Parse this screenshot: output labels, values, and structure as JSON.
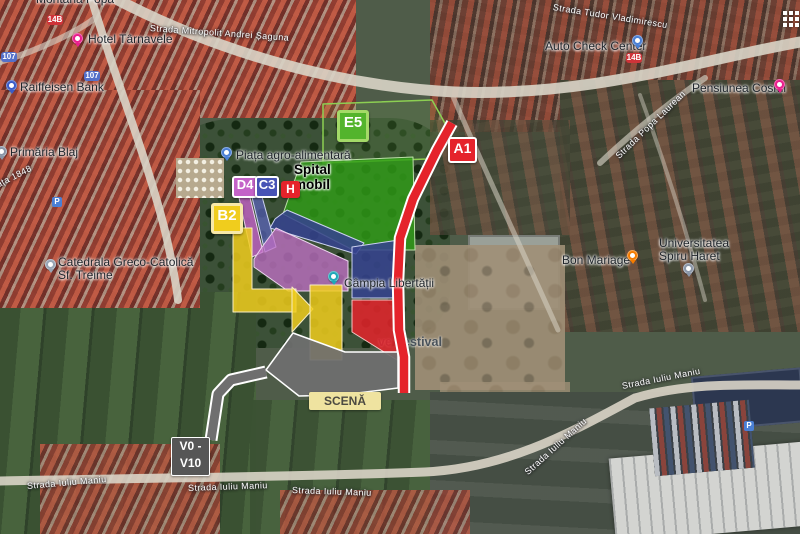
{
  "map": {
    "canvas": {
      "width": 800,
      "height": 534
    },
    "zones": [
      {
        "name": "zone-e5-area",
        "points": "323,104 432,100 447,127 427,159 323,163",
        "fill": "#7dc44a",
        "fill_opacity": 0.13,
        "stroke": "#8ccf52",
        "stroke_width": 1.5
      },
      {
        "name": "zone-green-field",
        "points": "301,162 413,157 415,250 353,250 283,214",
        "fill": "#2f9e17",
        "fill_opacity": 0.8,
        "stroke": "#bcdfa9",
        "stroke_width": 1
      },
      {
        "name": "zone-navy-band",
        "points": "275,219 287,210 364,243 356,254 270,228",
        "fill": "#36438f",
        "fill_opacity": 0.87,
        "stroke": "#ccd2f0",
        "stroke_width": 1
      },
      {
        "name": "zone-navy-block",
        "points": "352,247 399,240 399,298 352,298",
        "fill": "#36438f",
        "fill_opacity": 0.87,
        "stroke": "#ccd2f0",
        "stroke_width": 1
      },
      {
        "name": "zone-d4-path",
        "points": "238,193 249,193 263,252 252,257",
        "fill": "#c463c8",
        "fill_opacity": 0.8,
        "stroke": "#ecd4ee",
        "stroke_width": 1
      },
      {
        "name": "zone-c3-path",
        "points": "251,193 261,193 276,247 265,252",
        "fill": "#5a63b8",
        "fill_opacity": 0.75,
        "stroke": "#ccd2f0",
        "stroke_width": 1
      },
      {
        "name": "zone-purple",
        "points": "276,228 348,261 348,291 288,291 254,267 254,259 262,247",
        "fill": "#c06fc5",
        "fill_opacity": 0.78,
        "stroke": "#ecd4ee",
        "stroke_width": 1
      },
      {
        "name": "zone-yellow-path",
        "points": "233,228 252,228 252,289 296,289 296,312 233,312",
        "fill": "#f0cd1d",
        "fill_opacity": 0.85,
        "stroke": "#f8ecc2",
        "stroke_width": 1
      },
      {
        "name": "zone-yellow-arrow",
        "points": "292,287 313,309 292,332",
        "fill": "#f0cd1d",
        "fill_opacity": 0.85,
        "stroke": "#f8ecc2",
        "stroke_width": 1
      },
      {
        "name": "zone-yellow-block",
        "points": "310,285 342,285 342,360 310,360",
        "fill": "#f0cd1d",
        "fill_opacity": 0.85,
        "stroke": "#f8ecc2",
        "stroke_width": 1
      },
      {
        "name": "zone-red-block",
        "points": "352,300 397,300 397,360 352,332",
        "fill": "#e5232b",
        "fill_opacity": 0.85,
        "stroke": "#f5c5c5",
        "stroke_width": 1
      },
      {
        "name": "zone-stage-gray",
        "points": "293,333 345,352 398,352 398,388 341,395 299,396 266,370",
        "fill": "#6f6f6f",
        "fill_opacity": 0.93,
        "stroke": "#ffffff",
        "stroke_width": 1.5
      }
    ],
    "paths": [
      {
        "name": "stage-access-path",
        "points": "266,372 231,380 218,394 211,440",
        "color": "#6f6f6f",
        "width": 9,
        "casing_color": "#ffffff",
        "casing_width": 13
      },
      {
        "name": "route-a1",
        "points": "452,123 437,150 413,199 400,238 398,281 399,330 404,357 404,393",
        "color": "#e5232b",
        "width": 8.5,
        "casing_color": "#ffffff",
        "casing_width": 12.5
      }
    ],
    "overlay_badges": [
      {
        "name": "badge-e5",
        "label": "E5",
        "x": 337,
        "y": 110,
        "w": 26,
        "h": 26,
        "bg": "#53b42c",
        "border": "#a4da68",
        "border_w": 3,
        "font_size": 15
      },
      {
        "name": "badge-a1",
        "label": "A1",
        "x": 448,
        "y": 137,
        "w": 25,
        "h": 22,
        "bg": "#e5232b",
        "border": "#ffffff",
        "border_w": 2,
        "font_size": 14
      },
      {
        "name": "badge-d4",
        "label": "D4",
        "x": 232,
        "y": 176,
        "w": 22,
        "h": 18,
        "bg": "#c463c8",
        "border": "#ffffff",
        "border_w": 2,
        "font_size": 13
      },
      {
        "name": "badge-c3",
        "label": "C3",
        "x": 255,
        "y": 176,
        "w": 20,
        "h": 18,
        "bg": "#4753b5",
        "border": "#ffffff",
        "border_w": 2,
        "font_size": 13
      },
      {
        "name": "badge-h",
        "label": "H",
        "x": 281,
        "y": 181,
        "w": 19,
        "h": 17,
        "bg": "#e5232b",
        "border": "#e5232b",
        "border_w": 0,
        "font_size": 12
      },
      {
        "name": "badge-b2",
        "label": "B2",
        "x": 211,
        "y": 203,
        "w": 26,
        "h": 25,
        "bg": "#f0cd1d",
        "border": "#f7e9a8",
        "border_w": 3,
        "font_size": 15
      }
    ],
    "overlay_boxes": [
      {
        "name": "box-v0-v10",
        "lines": [
          "V0 -",
          "V10"
        ],
        "x": 171,
        "y": 437,
        "w": 37,
        "h": 37,
        "bg": "#565656",
        "color": "#ffffff",
        "border": "#ffffff",
        "font_size": 12
      },
      {
        "name": "box-scena",
        "lines": [
          "SCENĂ"
        ],
        "x": 309,
        "y": 392,
        "w": 70,
        "h": 16,
        "bg": "#efe3a0",
        "color": "#4c4a42",
        "border": "#efe3a0",
        "font_size": 12
      }
    ],
    "poi_labels": [
      {
        "name": "montana-popa",
        "text": "Montana Popa",
        "x": 36,
        "y": -7
      },
      {
        "name": "hotel-tarnavele",
        "text": "Hotel Târnavele",
        "x": 88,
        "y": 33,
        "icon": "hotel-pin",
        "icon_color": "#e91e8c",
        "icon_x": 72,
        "icon_y": 33
      },
      {
        "name": "raiffeisen-bank",
        "text": "Raiffeisen Bank",
        "x": 20,
        "y": 81,
        "icon": "bank-pin",
        "icon_color": "#3a5bc7",
        "icon_x": 6,
        "icon_y": 80
      },
      {
        "name": "primaria-blaj",
        "text": "Primăria Blaj",
        "x": 10,
        "y": 146,
        "icon": "government-pin",
        "icon_color": "#8a96a8",
        "icon_x": -4,
        "icon_y": 146
      },
      {
        "name": "catedrala-greco-catolica",
        "text": "Catedrala Greco-Catolică\nSf. Treime",
        "x": 58,
        "y": 256,
        "icon": "church-pin",
        "icon_color": "#97a5b5",
        "icon_x": 45,
        "icon_y": 259
      },
      {
        "name": "piata-agro-alimentara",
        "text": "Piața agro-alimentară",
        "x": 236,
        "y": 149,
        "icon": "market-pin",
        "icon_color": "#4a7fd4",
        "icon_x": 221,
        "icon_y": 147
      },
      {
        "name": "campia-libertatii",
        "text": "Câmpia Libertății",
        "x": 344,
        "y": 277,
        "icon": "park-pin",
        "icon_color": "#1fa8b8",
        "icon_x": 328,
        "icon_y": 271
      },
      {
        "name": "bon-mariage",
        "text": "Bon Mariage",
        "x": 562,
        "y": 254,
        "icon": "restaurant-pin",
        "icon_color": "#f57c00",
        "icon_x": 627,
        "icon_y": 250
      },
      {
        "name": "universitatea-spiru-haret",
        "text": "Universitatea\nSpiru Haret",
        "x": 659,
        "y": 237,
        "icon": "university-pin",
        "icon_color": "#8a96a8",
        "icon_x": 683,
        "icon_y": 263
      },
      {
        "name": "auto-check-center",
        "text": "Auto Check Center",
        "x": 545,
        "y": 40,
        "icon": "auto-pin",
        "icon_color": "#4a7fd4",
        "icon_x": 632,
        "icon_y": 35
      },
      {
        "name": "pensiunea-cosmi",
        "text": "Pensiunea Cosmi",
        "x": 692,
        "y": 82,
        "icon": "lodging-pin",
        "icon_color": "#e91e8c",
        "icon_x": 774,
        "icon_y": 79
      },
      {
        "name": "spital-mobil",
        "text": "Spital\nmobil",
        "x": 294,
        "y": 163,
        "variant": "overlay-black"
      },
      {
        "name": "festival",
        "text": "ve Festival",
        "x": 378,
        "y": 336,
        "variant": "festival"
      }
    ],
    "street_labels": [
      {
        "name": "strada-mitropolit-andrei-saguna",
        "text": "Strada Mitropolit Andrei Șaguna",
        "x": 150,
        "y": 23,
        "rotate": 4
      },
      {
        "name": "strada-tudor-vladimirescu",
        "text": "Strada Tudor Vladimirescu",
        "x": 553,
        "y": 2,
        "rotate": 9
      },
      {
        "name": "piata-1848",
        "text": "ața 1848",
        "x": -3,
        "y": 180,
        "rotate": -27
      },
      {
        "name": "strada-popa-laurean",
        "text": "Strada Popa Laurean",
        "x": 617,
        "y": 152,
        "rotate": -44
      },
      {
        "name": "strada-iuliu-maniu-1",
        "text": "Strada Iuliu Maniu",
        "x": 27,
        "y": 481,
        "rotate": -5
      },
      {
        "name": "strada-iuliu-maniu-2",
        "text": "Strada Iuliu Maniu",
        "x": 188,
        "y": 483,
        "rotate": -2
      },
      {
        "name": "strada-iuliu-maniu-3",
        "text": "Strada Iuliu Maniu",
        "x": 292,
        "y": 485,
        "rotate": 2
      },
      {
        "name": "strada-iuliu-maniu-4",
        "text": "Strada Iuliu Maniu",
        "x": 622,
        "y": 381,
        "rotate": -11
      },
      {
        "name": "strada-iuliu-maniu-5",
        "text": "Strada Iuliu Maniu",
        "x": 526,
        "y": 468,
        "rotate": -42
      }
    ],
    "road_badges": [
      {
        "name": "route-14b-west",
        "text": "14B",
        "type": "red",
        "x": 47,
        "y": 15
      },
      {
        "name": "route-107-north",
        "text": "107",
        "type": "blue",
        "x": 1,
        "y": 52
      },
      {
        "name": "route-107-south",
        "text": "107",
        "type": "blue",
        "x": 84,
        "y": 71
      },
      {
        "name": "route-14b-east",
        "text": "14B",
        "type": "red",
        "x": 626,
        "y": 53
      }
    ],
    "parking_icons": [
      {
        "name": "parking-icon-center",
        "text": "P",
        "x": 52,
        "y": 197
      },
      {
        "name": "parking-icon-industrial",
        "text": "P",
        "x": 744,
        "y": 421
      }
    ]
  }
}
